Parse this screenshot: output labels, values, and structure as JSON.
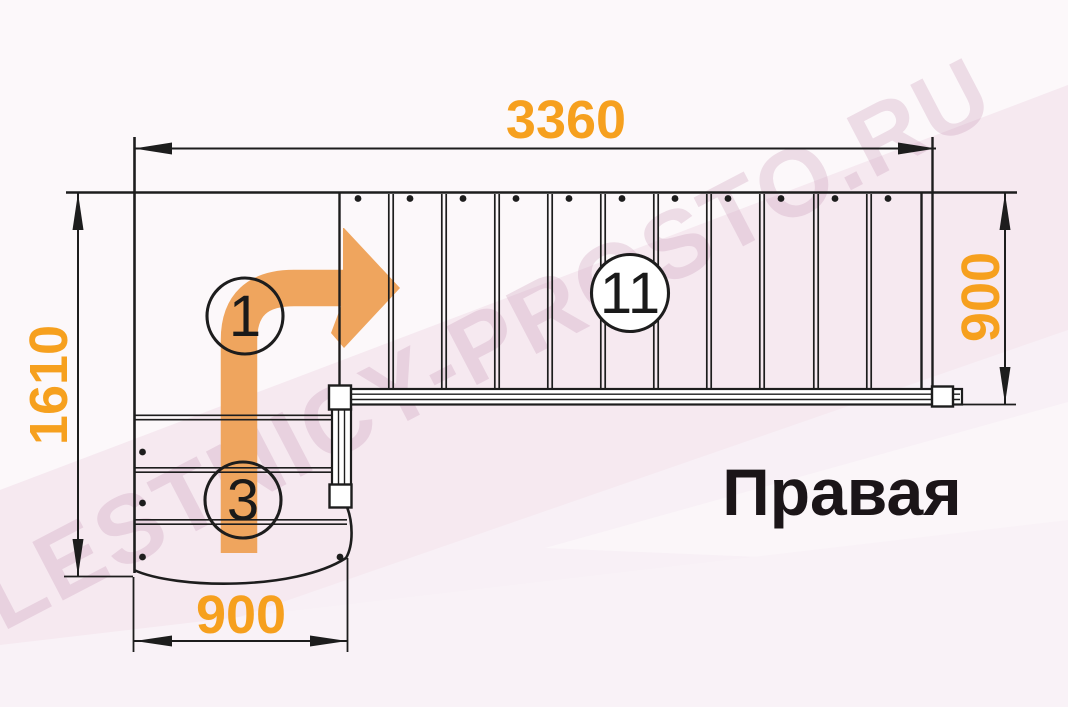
{
  "title": "Правая",
  "watermark": "LESTNICY-PROSTO.RU",
  "dimensions": {
    "top": "3360",
    "left": "1610",
    "bottom": "900",
    "right": "900"
  },
  "step_labels": {
    "first": "1",
    "third": "3",
    "eleventh": "11"
  },
  "colors": {
    "dimension_text": "#F6A01E",
    "direction_arrow": "#EFA55E",
    "linework": "#1D1D1D",
    "background": "#F8F0F6",
    "watermark": "#C795B4"
  }
}
